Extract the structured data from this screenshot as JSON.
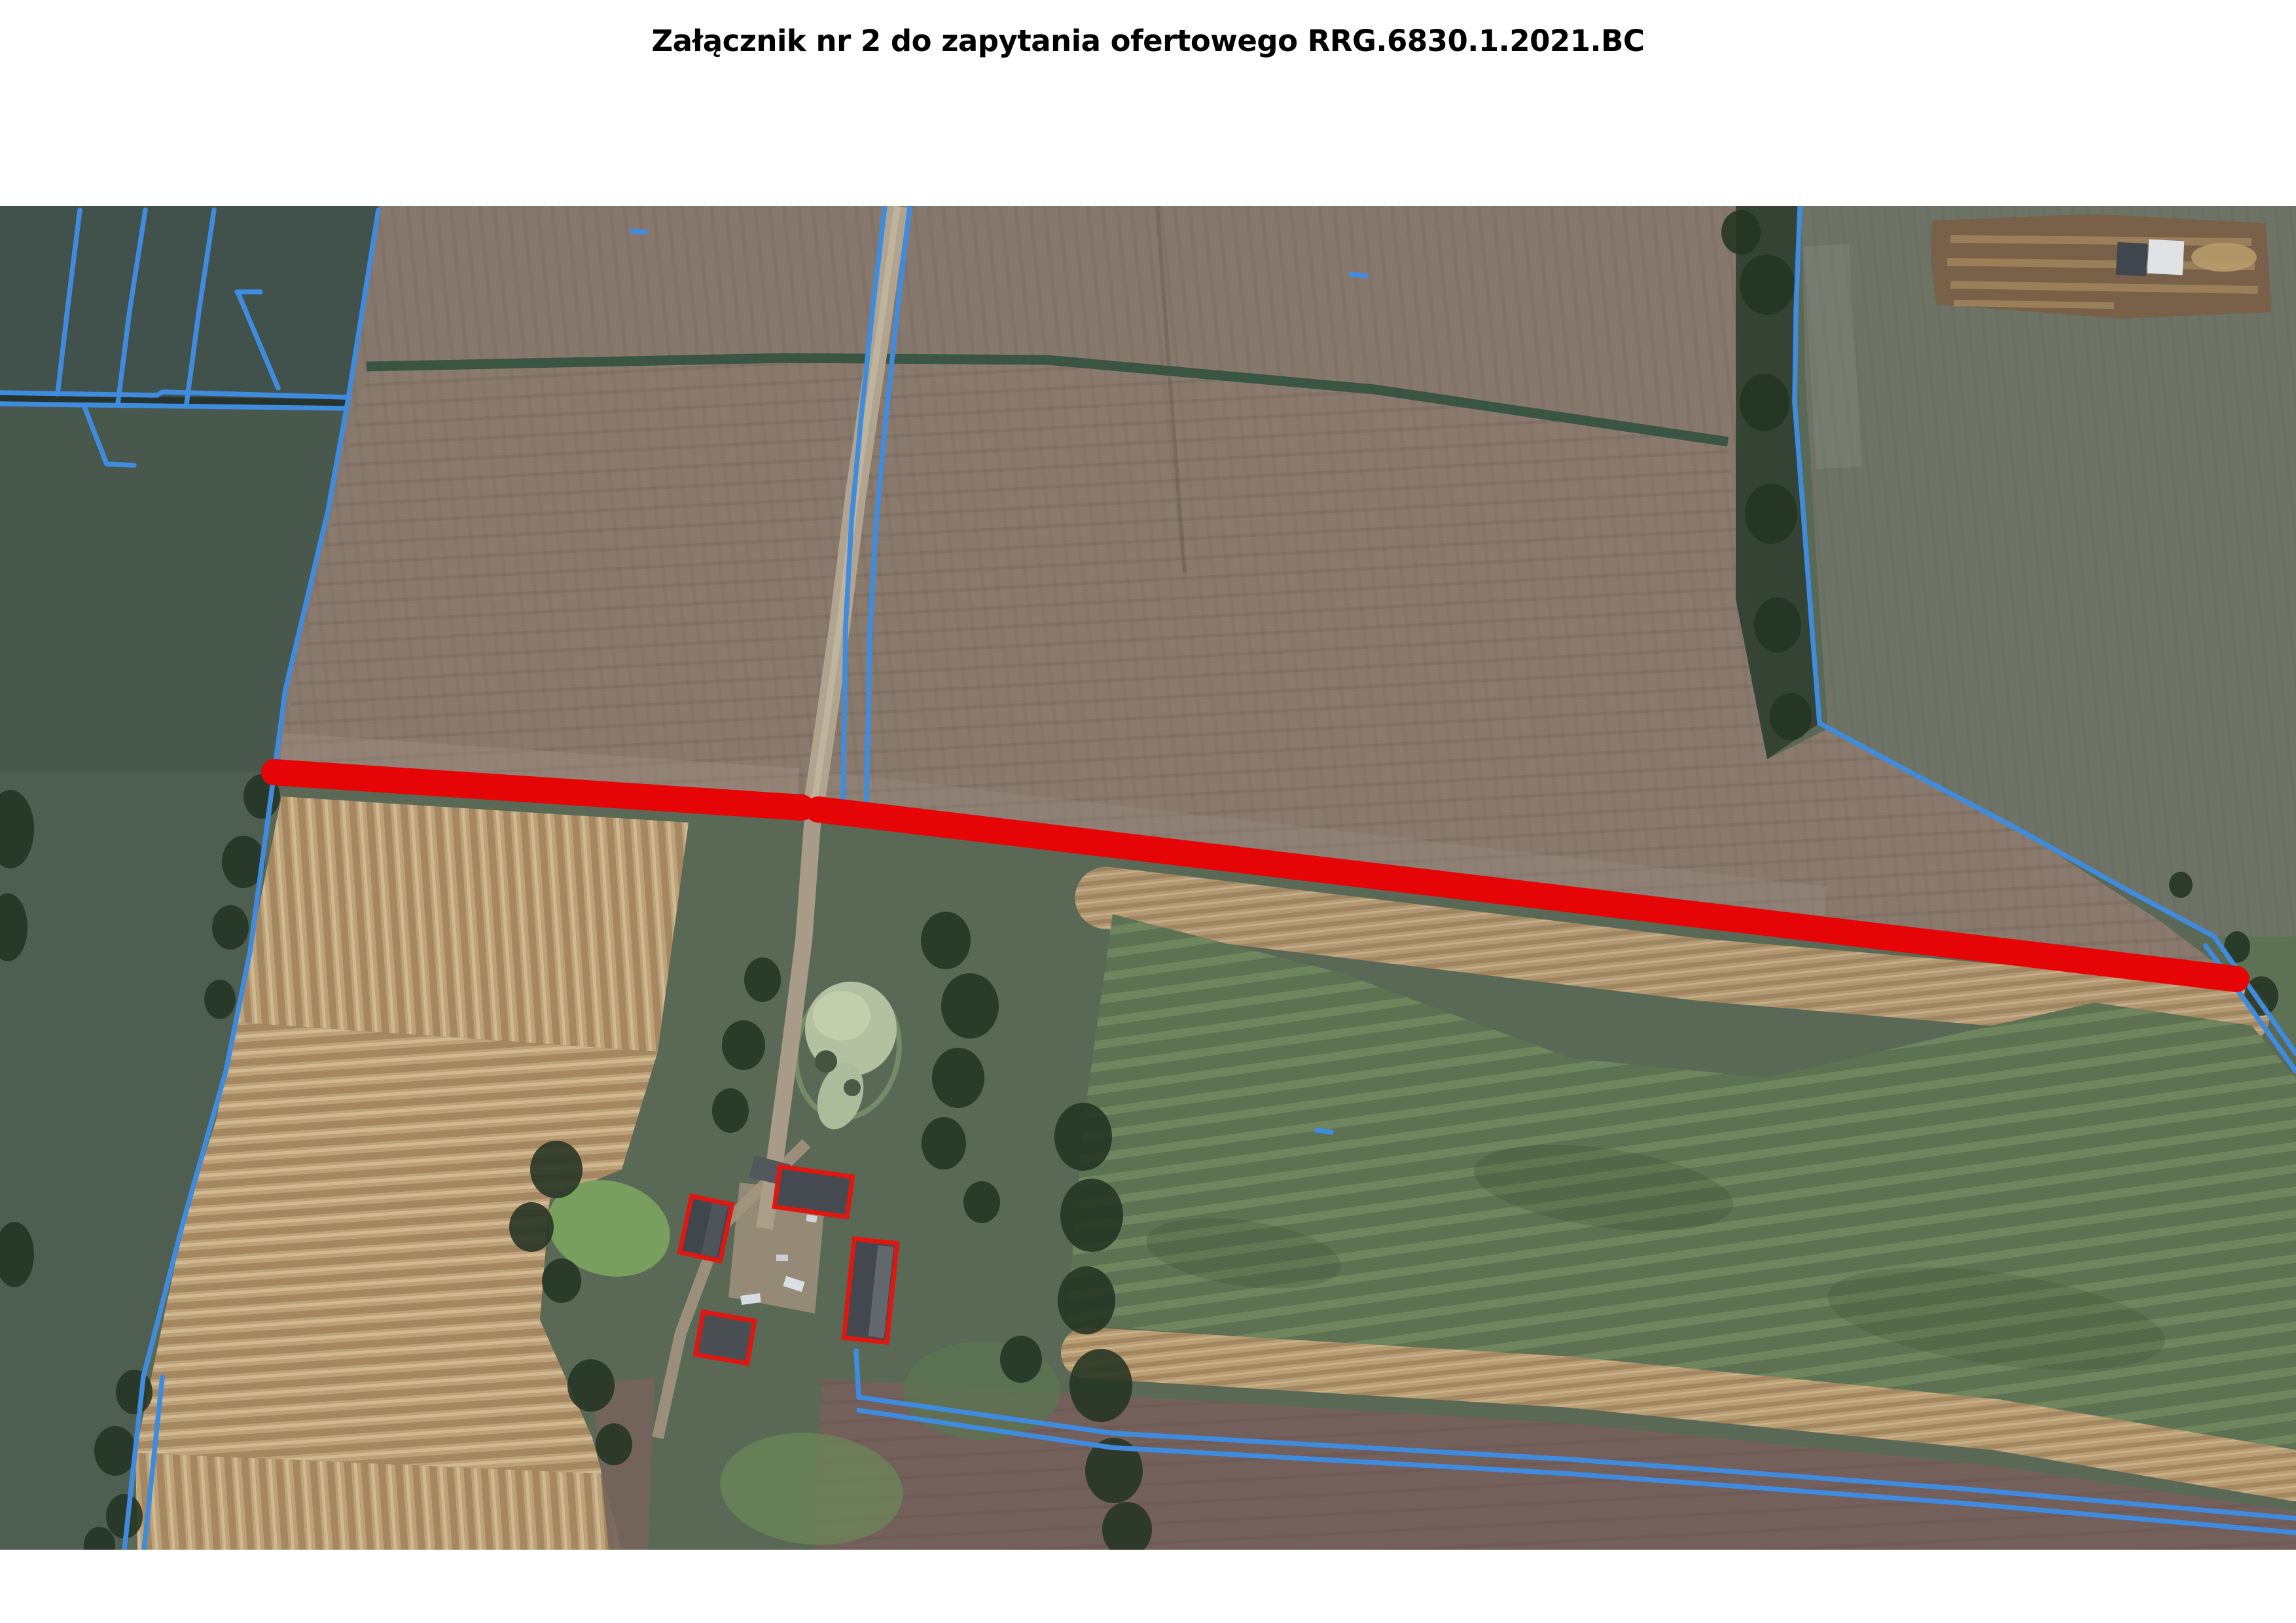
{
  "page": {
    "title": "Załącznik nr 2 do zapytania ofertowego RRG.6830.1.2021.BC"
  },
  "theme": {
    "page_bg": "#ffffff",
    "title_color": "#000000",
    "route_red": "#ee0000",
    "parcel_blue": "#3f8ee4",
    "building_outline_red": "#e8120c"
  },
  "map": {
    "kind": "aerial-orthophoto",
    "route_marking_segments": 2,
    "outlined_buildings": 4
  }
}
